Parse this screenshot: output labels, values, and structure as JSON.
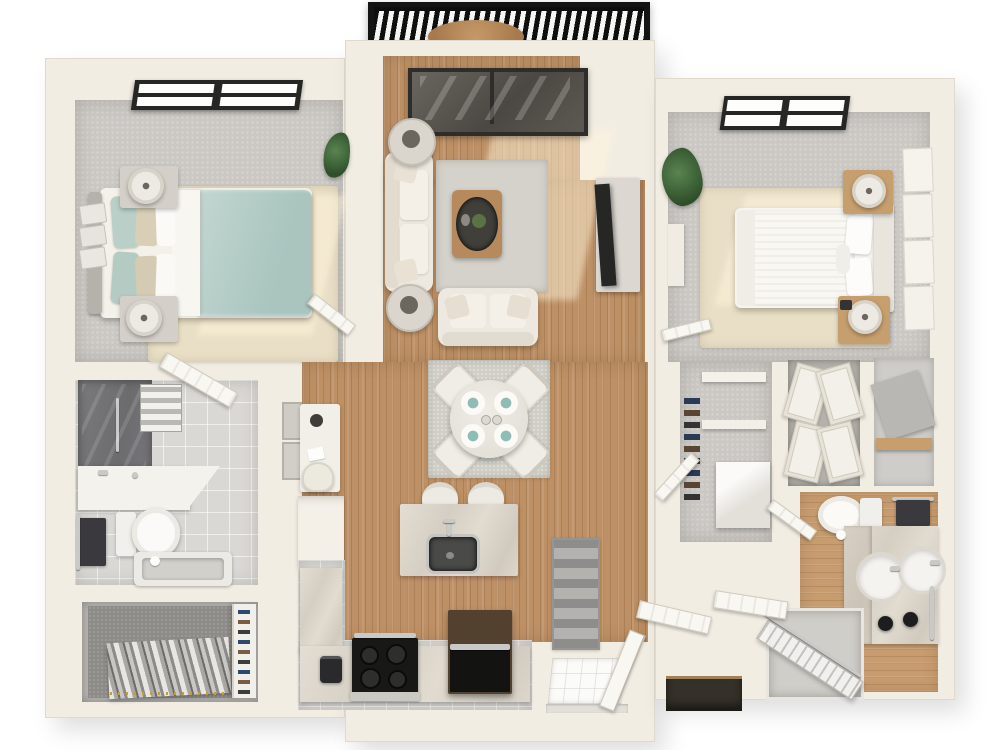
{
  "scene": {
    "view": "top-down 3d rendered floor plan",
    "unit": "2 bedroom, 2 bathroom apartment with balcony",
    "floor_types": [
      "hardwood",
      "carpet",
      "tile"
    ]
  },
  "palette": {
    "wall": "#f2ede3",
    "wallEdge": "#ddd6c8",
    "wood": "#bd9065",
    "woodLight": "#c79c6f",
    "carpet": "#cbc8c4",
    "carpetDark": "#8e8c89",
    "rugBeige": "#e9dfc6",
    "rugGray": "#d4d2ca",
    "tile": "#d9d8d4",
    "entry": "#fbfbf9",
    "dark": "#242424",
    "glass": "#55524e",
    "teal": "#b7cfc9",
    "tealPlate": "#8fbdb6",
    "tan": "#c79f6f",
    "appliance": "#181817",
    "fridgeTop": "#53412f",
    "towel": "#3a393d",
    "metal": "#c9c9c7",
    "plant": "#3e6b3e",
    "balcony": "#141414"
  },
  "rooms": [
    {
      "id": "balcony",
      "items": [
        "slat-railing",
        "bistro-table"
      ]
    },
    {
      "id": "bedroom-1",
      "items": [
        "bed-teal-duvet",
        "headboard",
        "pillows",
        "nightstand",
        "nightstand",
        "table-lamp",
        "table-lamp",
        "wall-baskets",
        "area-rug",
        "window",
        "door"
      ]
    },
    {
      "id": "living-room",
      "items": [
        "sofa",
        "loveseat",
        "coffee-table",
        "plant-centerpiece",
        "side-table",
        "side-table",
        "table-lamp",
        "table-lamp",
        "area-rug",
        "tv-console",
        "tv",
        "sliding-glass-door"
      ]
    },
    {
      "id": "bedroom-2",
      "items": [
        "bed-white-duvet",
        "headboard",
        "pillows",
        "nightstand",
        "nightstand",
        "table-lamp",
        "table-lamp",
        "area-rug",
        "window",
        "wall-art-panels",
        "plant",
        "desk",
        "door"
      ]
    },
    {
      "id": "dining-area",
      "items": [
        "round-table",
        "chair",
        "chair",
        "chair",
        "chair",
        "place-setting-teal",
        "place-setting-teal",
        "place-setting-teal",
        "place-setting-teal",
        "area-rug"
      ]
    },
    {
      "id": "kitchen",
      "items": [
        "island",
        "island-sink",
        "faucet",
        "bar-stool",
        "bar-stool",
        "range",
        "toaster",
        "refrigerator",
        "l-shaped-counter",
        "pantry-cabinet"
      ]
    },
    {
      "id": "hallway",
      "items": [
        "desk",
        "desk-lamp",
        "desk-chair",
        "wall-frames",
        "runner-rug"
      ]
    },
    {
      "id": "bathroom-1",
      "items": [
        "walk-in-shower",
        "shower-handle",
        "towel-shelf",
        "vanity-sink",
        "faucet",
        "toilet",
        "dark-towel",
        "bathtub",
        "door"
      ]
    },
    {
      "id": "closet-1",
      "items": [
        "hanging-clothes",
        "hanger-rod",
        "shoe-rack"
      ]
    },
    {
      "id": "walk-in-closet",
      "items": [
        "shelf",
        "shelf",
        "shoe-stack",
        "dresser",
        "door"
      ]
    },
    {
      "id": "linen-closet",
      "items": [
        "bifold-door",
        "bifold-door",
        "bifold-door",
        "bifold-door"
      ]
    },
    {
      "id": "utility-closet",
      "items": [
        "shelf-board",
        "wood-shelf"
      ]
    },
    {
      "id": "bathroom-2",
      "items": [
        "toilet",
        "dark-towel",
        "double-vanity",
        "sink",
        "sink",
        "faucet",
        "faucet",
        "stool",
        "stool",
        "towel-bar",
        "shower",
        "shower-door"
      ]
    },
    {
      "id": "entry",
      "items": [
        "front-door",
        "tile-mat",
        "threshold"
      ]
    },
    {
      "id": "hall-closet",
      "items": [
        "open-door",
        "open-door",
        "dark-shelf"
      ]
    }
  ]
}
